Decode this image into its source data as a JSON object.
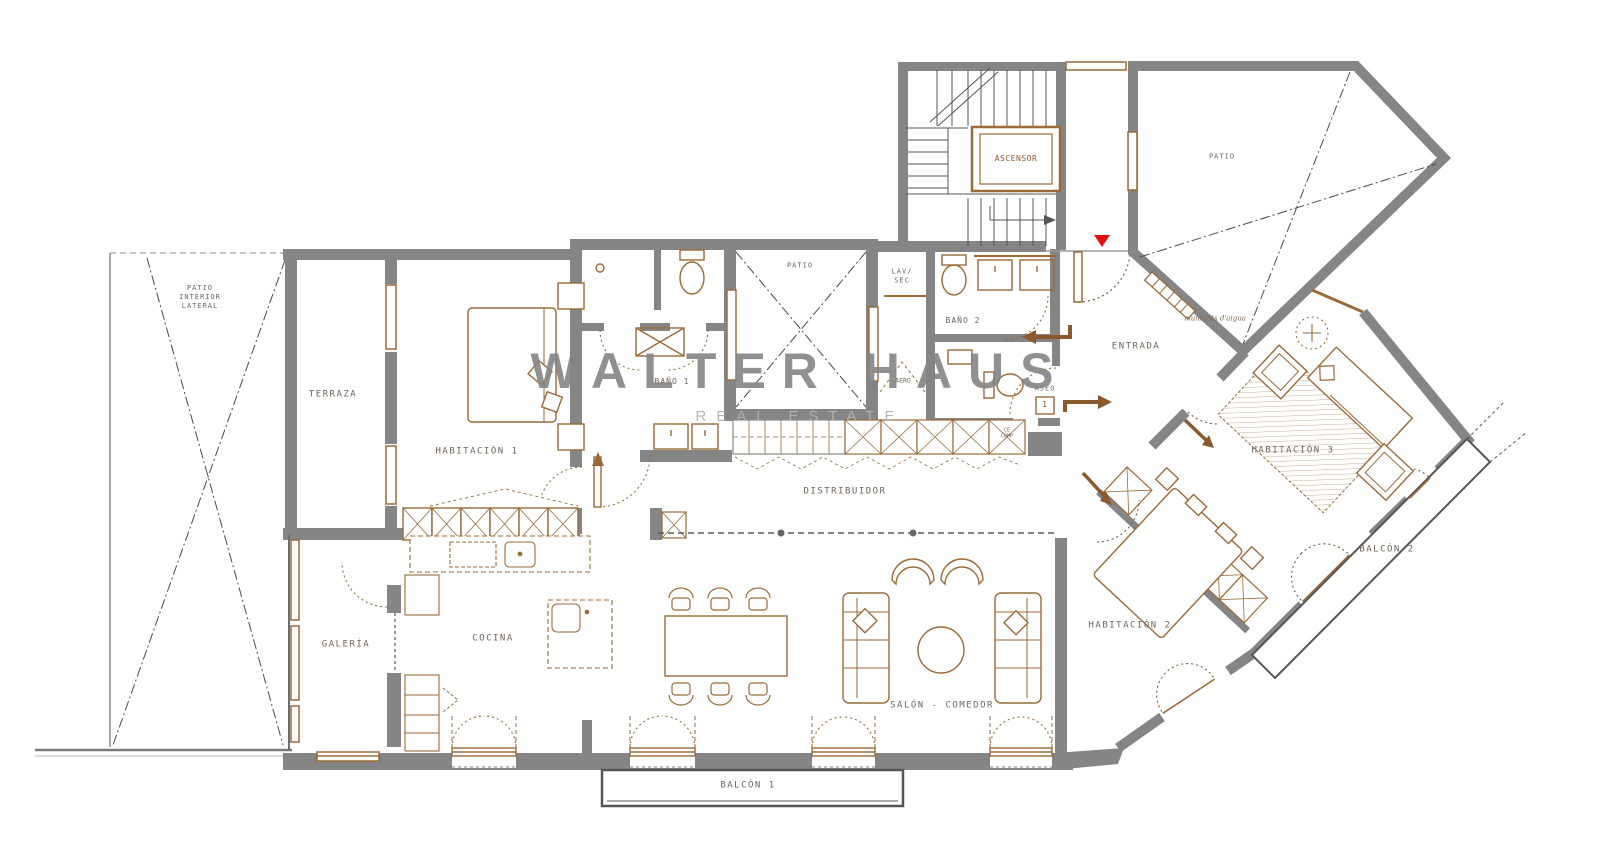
{
  "watermark": {
    "title": "WALTER HAUS",
    "subtitle": "REAL ESTATE"
  },
  "rooms": {
    "patio_interior_lateral": "PATIO\nINTERIOR\nLATERAL",
    "terraza": "TERRAZA",
    "habitacion_1": "HABITACIÓN 1",
    "bano_1": "BAÑO 1",
    "patio_central": "PATIO",
    "lav_sec": "LAV/\nSEC",
    "bano_2": "BAÑO 2",
    "aseo": "ASEO",
    "aero": "AERO",
    "entrada": "ENTRADA",
    "ascensor": "ASCENSOR",
    "patio": "PATIO",
    "distribuidor": "DISTRIBUIDOR",
    "cocina": "COCINA",
    "galeria": "GALERÍA",
    "salon_comedor": "SALÓN - COMEDOR",
    "habitacion_2": "HABITACIÓN 2",
    "habitacion_3": "HABITACIÓN 3",
    "balcon_1": "BALCÓN 1",
    "balcon_2": "BALCÓN 2"
  },
  "annotations": {
    "muntants": "muntants d'aigua",
    "marker_1": "1",
    "ce_comp": "CE\nCOMP"
  },
  "colors": {
    "wall": "#858585",
    "furniture": "#9a6a38",
    "label": "#6f655b",
    "marker_red": "#e01010",
    "watermark": "#868686"
  }
}
